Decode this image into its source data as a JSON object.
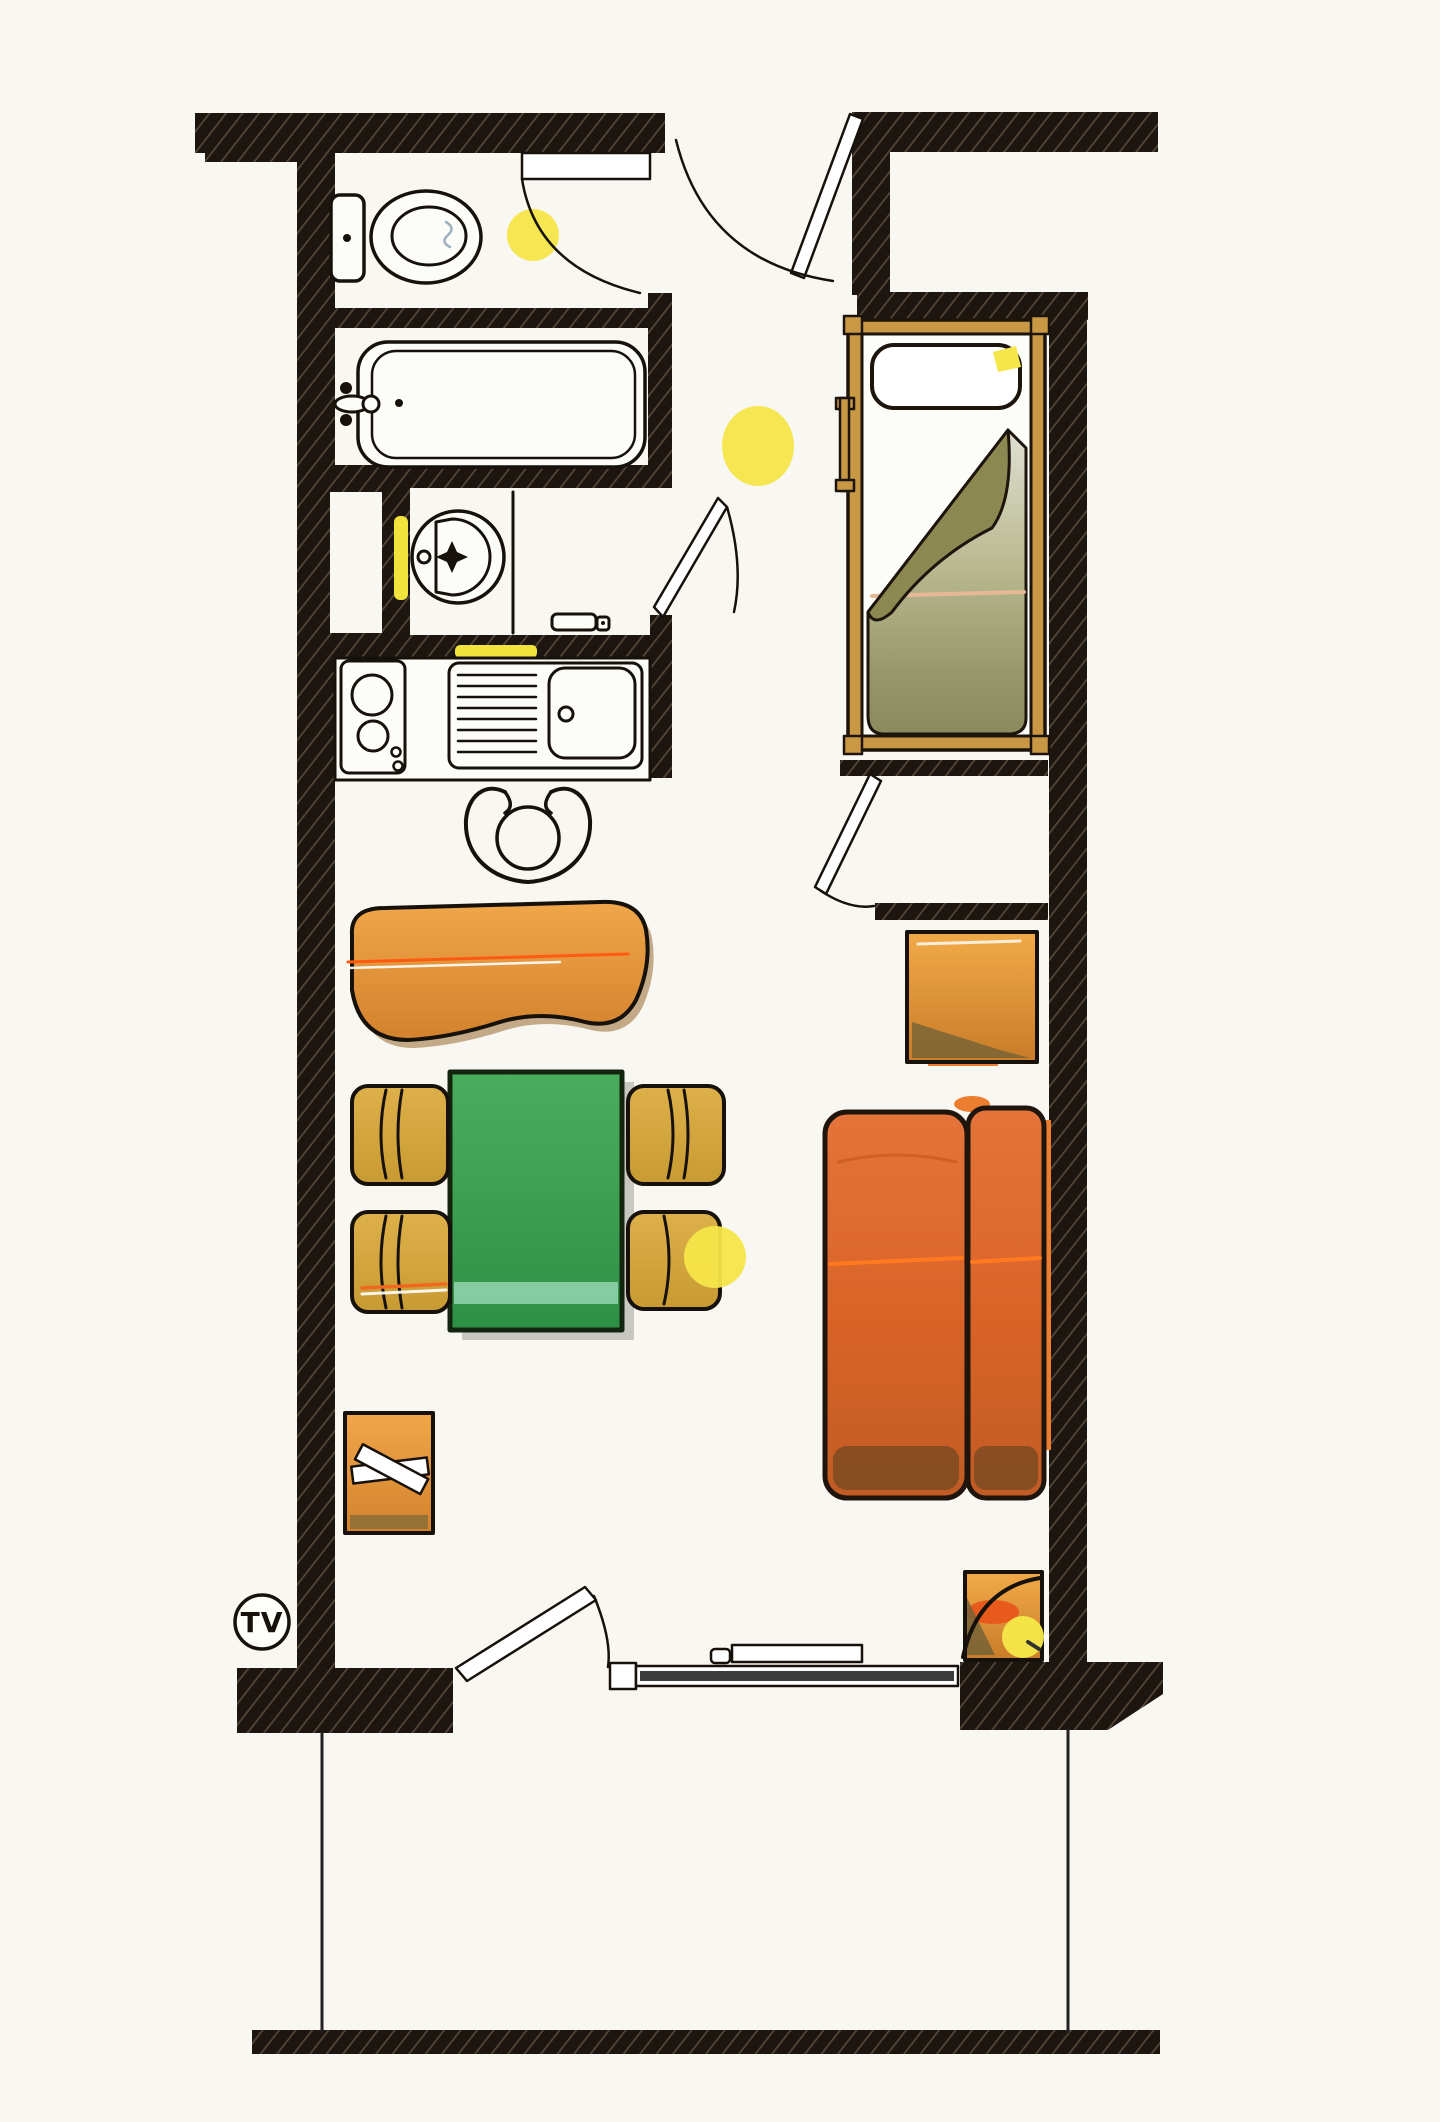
{
  "title": "studio-apartment-floor-plan",
  "labels": {
    "tv": "TV"
  },
  "palette": {
    "paper": "#f8f7f2",
    "wall_fill": "#1c1510",
    "wall_hatch": "#544737",
    "highlight_yellow": "#f5e649",
    "sofa_orange": "#dd6c2c",
    "bench_orange": "#e6973d",
    "chair_gold": "#d2a63b",
    "table_green": "#3fa351",
    "bed_frame_gold": "#c99844",
    "blanket_olive": "#8b8851",
    "ink": "#17110b"
  },
  "fixtures": [
    "toilet",
    "bathtub",
    "washbasin",
    "towel-yellow",
    "kitchen-stove",
    "kitchen-sink",
    "kitchen-chair",
    "entrance-door",
    "wc-door",
    "washroom-door",
    "bedroom-door",
    "single-bed",
    "pillow",
    "folded-blanket",
    "wardrobe",
    "bench-seat",
    "dining-table",
    "dining-chair",
    "luggage-rack",
    "sofa",
    "nightstand",
    "balcony-door",
    "window",
    "balcony",
    "ceiling-light",
    "tv-outlet"
  ],
  "lights_count": 4
}
